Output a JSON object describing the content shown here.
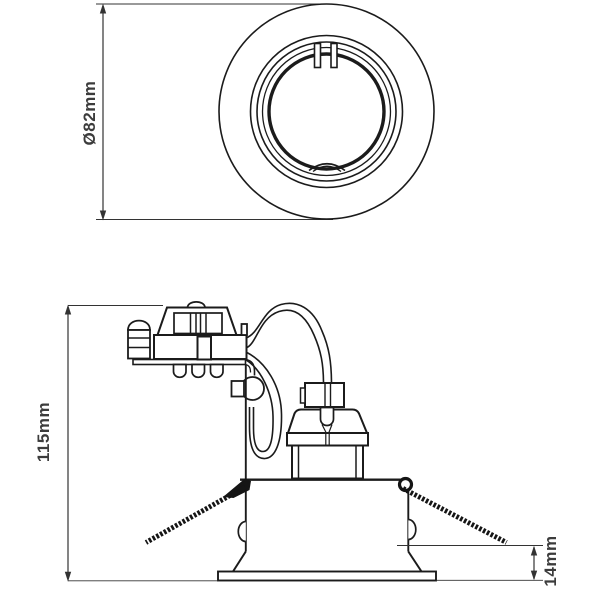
{
  "drawing": {
    "kind": "technical-dimension-drawing",
    "top_view": {
      "dimension_diameter": "Ø82mm"
    },
    "side_view": {
      "dimension_height": "115mm",
      "dimension_trim_height": "14mm"
    },
    "colors": {
      "line": "#1b1b1b",
      "dimension_line": "#333333",
      "label_text": "#3c3c3c",
      "background": "#ffffff"
    }
  }
}
